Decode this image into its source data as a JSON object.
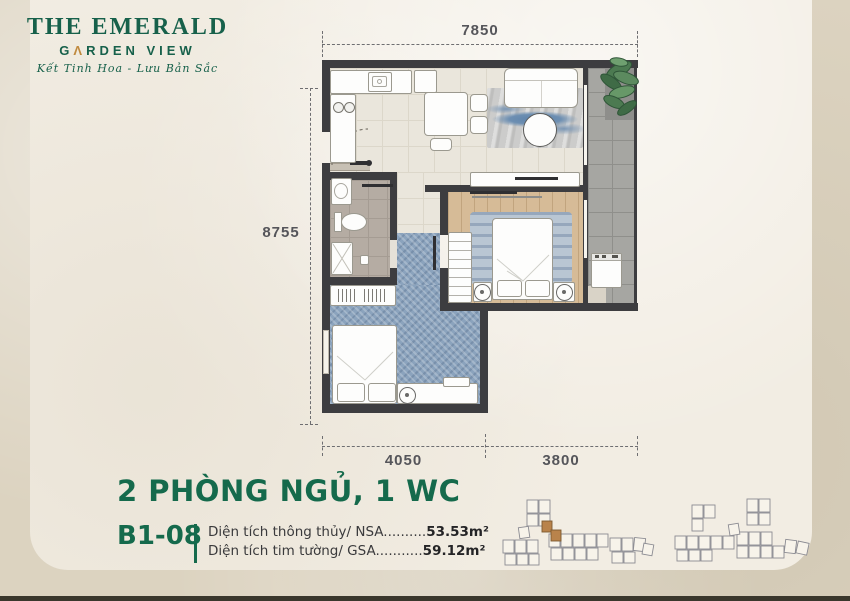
{
  "brand": {
    "name_line1": "THE EMERALD",
    "name_line2_pre": "G",
    "name_line2_a": "Λ",
    "name_line2_post": "RDEN VIEW",
    "tagline": "Kết Tinh Hoa - Lưu Bản Sắc",
    "green": "#17614b",
    "gold": "#c08a3e"
  },
  "plan": {
    "dim_top": "7850",
    "dim_left": "8755",
    "dim_bottom_left": "4050",
    "dim_bottom_right": "3800"
  },
  "info": {
    "title": "2 PHÒNG NGỦ, 1 WC",
    "unit_code": "B1-08",
    "title_color": "#156a4c",
    "areas": [
      {
        "label": "Diện tích thông thủy/ NSA",
        "dots": "..........",
        "value": "53.53m²"
      },
      {
        "label": "Diện tích tim tường/ GSA",
        "dots": "...........",
        "value": "59.12m²"
      }
    ]
  },
  "site_plan": {
    "highlight_color": "#b9834b",
    "outline_color": "#8b8b92"
  }
}
